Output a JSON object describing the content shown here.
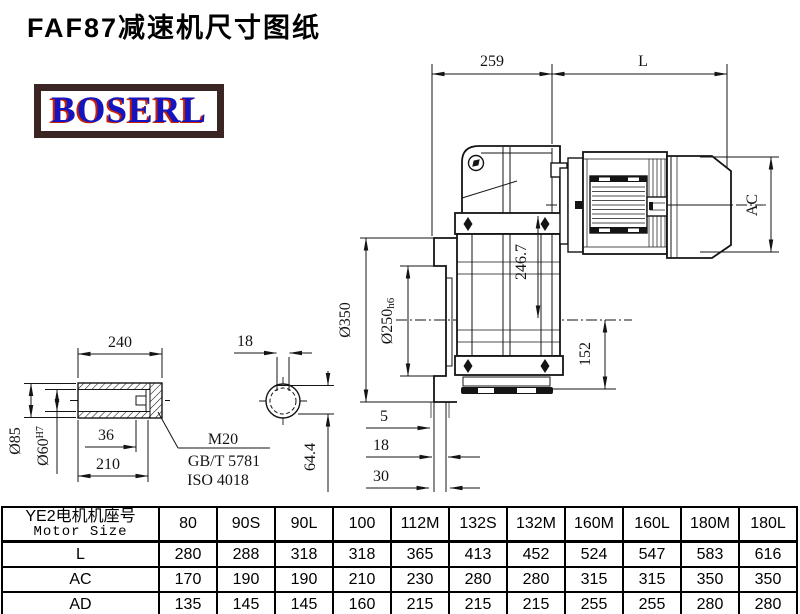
{
  "title": "FAF87减速机尺寸图纸",
  "logo": {
    "text": "BOSERL"
  },
  "colors": {
    "line": "#141414",
    "logo_text": "#1515c0",
    "logo_shadow": "#cc2200",
    "logo_border": "#3a2424",
    "background": "#ffffff"
  },
  "main_view": {
    "dim_width_259": "259",
    "dim_motor_length": "L",
    "dim_motor_diameter": "AC",
    "dim_height_246_7": "246.7",
    "dim_height_152": "152",
    "dim_flange_diameter": "Ø350",
    "dim_spigot_diameter": "Ø250",
    "dim_spigot_tolerance": "h6",
    "dim_step_5": "5",
    "dim_step_18": "18",
    "dim_step_30": "30"
  },
  "shaft_view": {
    "dim_length_240": "240",
    "dim_keyway_36": "36",
    "dim_length_210": "210",
    "dim_outer_diameter": "Ø85",
    "dim_bore_diameter": "Ø60",
    "dim_bore_tolerance": "H7",
    "thread_note": "M20",
    "standard_note_1": "GB/T 5781",
    "standard_note_2": "ISO 4018",
    "dim_keyway_width_18": "18",
    "dim_keyway_depth_64_4": "64.4"
  },
  "table": {
    "header_cn": "YE2电机机座号",
    "header_en": "Motor Size",
    "columns": [
      "80",
      "90S",
      "90L",
      "100",
      "112M",
      "132S",
      "132M",
      "160M",
      "160L",
      "180M",
      "180L"
    ],
    "rows": [
      {
        "label": "L",
        "values": [
          "280",
          "288",
          "318",
          "318",
          "365",
          "413",
          "452",
          "524",
          "547",
          "583",
          "616"
        ]
      },
      {
        "label": "AC",
        "values": [
          "170",
          "190",
          "190",
          "210",
          "230",
          "280",
          "280",
          "315",
          "315",
          "350",
          "350"
        ]
      },
      {
        "label": "AD",
        "values": [
          "135",
          "145",
          "145",
          "160",
          "215",
          "215",
          "215",
          "255",
          "255",
          "280",
          "280"
        ]
      }
    ]
  }
}
